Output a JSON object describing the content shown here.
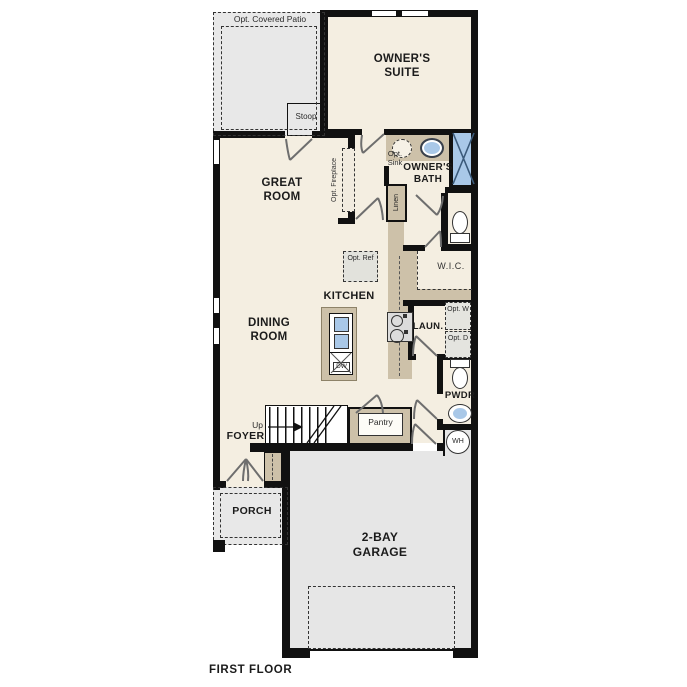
{
  "floor_plan": {
    "caption": "FIRST FLOOR",
    "rooms": {
      "patio": "Opt. Covered Patio",
      "stoop": "Stoop",
      "owners_suite": "OWNER'S SUITE",
      "owners_bath": "OWNER'S BATH",
      "wic": "W.I.C.",
      "great_room": "GREAT ROOM",
      "dining_room": "DINING ROOM",
      "kitchen": "KITCHEN",
      "laundry": "LAUN.",
      "powder": "PWDR",
      "foyer": "FOYER",
      "porch": "PORCH",
      "garage": "2-BAY GARAGE"
    },
    "features": {
      "opt_sink": "Opt. Sink",
      "linen": "Linen",
      "opt_fireplace": "Opt. Fireplace",
      "opt_ref": "Opt. Ref",
      "dishwasher": "DW",
      "opt_washer": "Opt. W",
      "opt_dryer": "Opt. D",
      "water_heater": "WH",
      "stairs_up": "Up",
      "pantry": "Pantry"
    },
    "colors": {
      "wall": "#111111",
      "floor": "#f4eee1",
      "cabinet": "#cdc1a9",
      "concrete": "#e8e8e8",
      "fixture_blue": "#a9c8e8"
    }
  }
}
